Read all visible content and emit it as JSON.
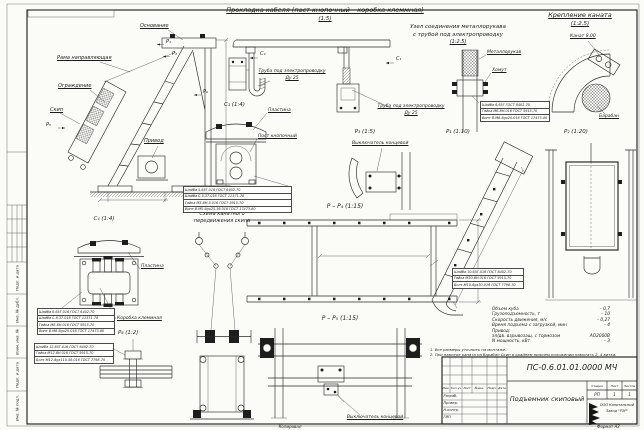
{
  "sheet": {
    "copied_label": "Копировал",
    "format_label": "Формат А2"
  },
  "side_stamp": {
    "cells": [
      "Подп. и дата",
      "Инв. № дубл.",
      "Взам. инв. №",
      "Подп. и дата",
      "Инв. № подл."
    ]
  },
  "top_titles": {
    "cable_title": "Прокладка кабеля (пост кнопочный – коробка клеммная)",
    "cable_scale": "(1:5)",
    "sleeve_title_1": "Узел соединения металлорукава",
    "sleeve_title_2": "с трубой под электропроводку",
    "sleeve_scale": "(1:2.5)",
    "rope_title": "Крепление каната",
    "rope_scale": "(1:2.5)"
  },
  "view_titles": {
    "c1": "С₁ (1:4)",
    "c4": "С₄ (1:4)",
    "p1": "Р₁ (1:10)",
    "p2": "Р₂ (1:20)",
    "p3": "Р₃ (1:5)",
    "pp4": "Р – Р₄ (1:15)",
    "pp5": "Р – Р₅ (1:15)",
    "p6": "Р₆ (1:2)",
    "scheme_1": "Схема канатного",
    "scheme_2": "передвижения скипа"
  },
  "labels": {
    "osnovanie": "Основание",
    "rama": "Рама направляющая",
    "ograzhdenie": "Ограждение",
    "skip": "Скип",
    "privod": "Привод",
    "tube_1": "Труба под электропроводку",
    "tube_2": "Ду 25",
    "metallorukav": "Металлорукав",
    "khomut": "Хомут",
    "kanat": "Канат 8.00",
    "baraban": "Барабан",
    "plastina": "Пластина",
    "post": "Пост кнопочный",
    "korobka": "Коробка клеммная",
    "switch": "Выключатель концевой"
  },
  "marks": {
    "p1": "Р₁",
    "p2": "Р₂",
    "p5": "Р₅",
    "p6": "Р₆",
    "c1": "С₁",
    "c4": "С₄"
  },
  "callouts": {
    "post": [
      "Шайба 5.65Г.016 ГОСТ 6402-70",
      "Шайба С.5.37.016 ГОСТ 11371-78",
      "Гайка М5-6Н.5.016 ГОСТ 5915-70",
      "Винт В.М5-6gх25.36.016 ГОСТ 17473-80"
    ],
    "box": [
      "Шайба 8.65Г.016 ГОСТ 6402-70",
      "Шайба С.8.37.016 ГОСТ 11371-78",
      "Гайка М8-6Н.016 ГОСТ 5915-70",
      "Винт В.М8-6gх20.016 ГОСТ 17473-80"
    ],
    "sleeve": [
      "Шайба 6.65Г ГОСТ 6402-70",
      "Гайка М6-6Н.016 ГОСТ 5915-70",
      "Винт В.М6-6gх20.016 ГОСТ 17473-80"
    ],
    "bolt": [
      "Шайба 12.65Г.016 ГОСТ 6402-70",
      "Гайка М12-6Н.016 ГОСТ 5915-70",
      "Болт М12-6gх110.58.016 ГОСТ 7798-70"
    ],
    "pp4": [
      "Шайба 10.65Г.016 ГОСТ 6402-70",
      "Гайка М10-6Н.016 ГОСТ 5915-70",
      "Болт М10-6gх30.016 ГОСТ 7798-70"
    ]
  },
  "tech": {
    "rows": [
      {
        "label": "Объем куба",
        "value": "– 0,7"
      },
      {
        "label": "Грузоподъемность, т",
        "value": "– 10"
      },
      {
        "label": "Скорость движения, м/с",
        "value": "– 0,27"
      },
      {
        "label": "Время подъема с загрузкой, мин",
        "value": "– 4"
      },
      {
        "label": "Привод:",
        "value": ""
      },
      {
        "label": "эл/дв. взрывозащ. с тормозом",
        "value": "АО2000В"
      },
      {
        "label": "N мощность, кВт",
        "value": "– 3"
      }
    ]
  },
  "notes": [
    "1. Все размеры уточнить на монтаже.",
    "2. При намотке каната на барабан Скип в крайнем нижнем положении намотать 2, 4 витка."
  ],
  "title_block": {
    "doc_number": "ПС-0.6.01.01.0000 МЧ",
    "doc_title": "Подъемник скиповый",
    "header_cols": [
      "Изм.",
      "Кол.уч",
      "Лист",
      "№док.",
      "Подп.",
      "Дата"
    ],
    "row_labels": [
      "Разраб.",
      "Провер.",
      "Н.контр.",
      "ГИП"
    ],
    "stage_cols": [
      "Стадия",
      "Лист",
      "Листов"
    ],
    "stage_vals": [
      "РП",
      "1",
      "1"
    ],
    "company_1": "ООО Капитальный",
    "company_2": "Завод \"РЭР\""
  }
}
